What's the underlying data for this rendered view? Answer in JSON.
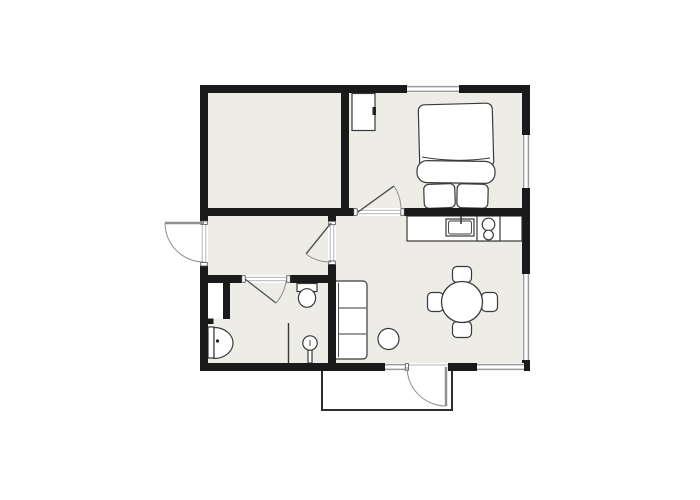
{
  "page": {
    "title": "Apartment floor plan"
  },
  "colors": {
    "background": "#ffffff",
    "floor": "#edece7",
    "wall": "#1a1a1a",
    "window": "#9a9a9a",
    "outline": "#3a3a3a",
    "arc": "#909090"
  },
  "furniture": {
    "bed": "double-bed",
    "wardrobe": "wardrobe-cabinet",
    "kitchen_counter": "kitchen-counter",
    "kitchen_sink": "kitchen-sink",
    "stove": "stove-two-burners",
    "dining_table": "round-dining-table",
    "dining_chairs": "four-dining-chairs",
    "sofa": "three-seat-sofa",
    "side_table": "round-side-table",
    "toilet": "toilet",
    "washbasin": "wall-washbasin",
    "pedestal_sink": "pedestal-washbasin",
    "shower_screen": "partition-line",
    "porch": "entrance-porch"
  },
  "openings": {
    "exterior_doors": "2",
    "interior_doors": "3",
    "windows": "5"
  }
}
